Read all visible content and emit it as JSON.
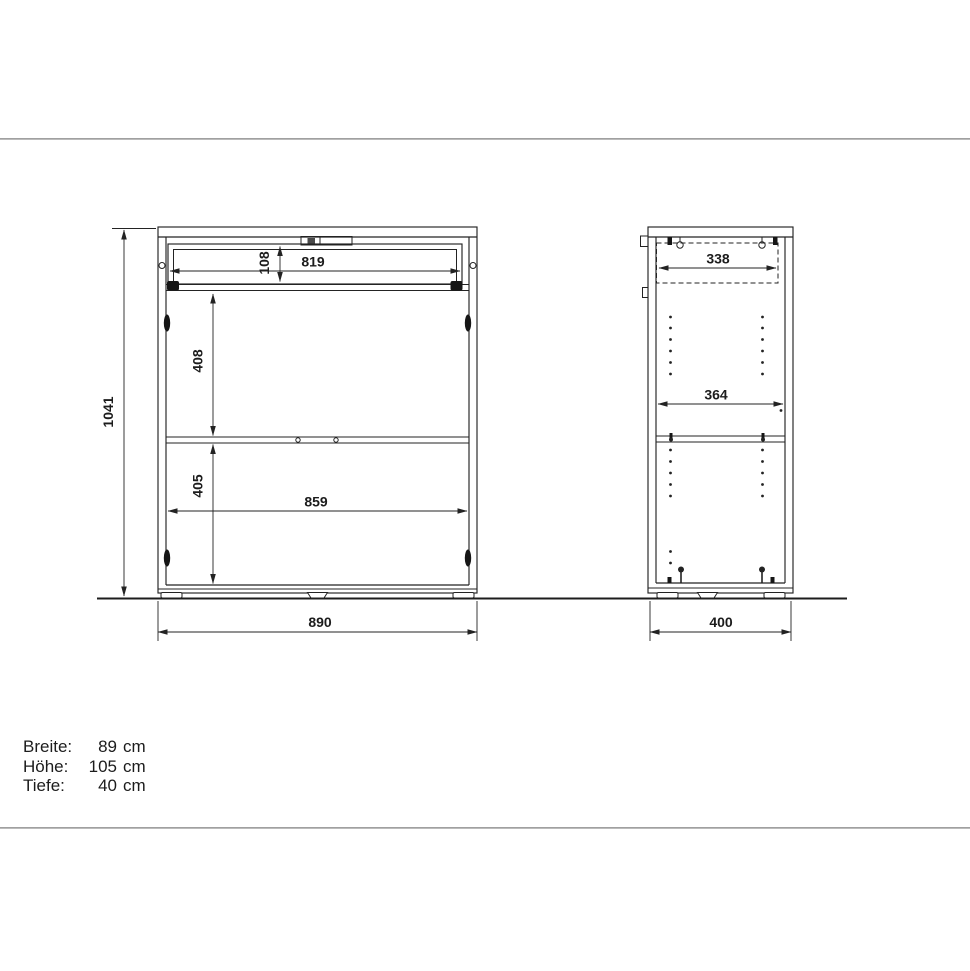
{
  "colors": {
    "line": "#232323",
    "separator": "#a3a3a3",
    "background": "#ffffff"
  },
  "front_view": {
    "overall_height_mm": "1041",
    "drawer_inner_height_mm": "108",
    "drawer_inner_width_mm": "819",
    "upper_section_height_mm": "408",
    "lower_section_height_mm": "405",
    "inner_width_mm": "859",
    "overall_width_mm": "890"
  },
  "side_view": {
    "drawer_inner_depth_mm": "338",
    "inner_depth_mm": "364",
    "overall_depth_mm": "400"
  },
  "specifications": {
    "rows": [
      {
        "label": "Breite:",
        "value": "89",
        "unit": "cm"
      },
      {
        "label": "Höhe:",
        "value": "105",
        "unit": "cm"
      },
      {
        "label": "Tiefe:",
        "value": "40",
        "unit": "cm"
      }
    ]
  }
}
